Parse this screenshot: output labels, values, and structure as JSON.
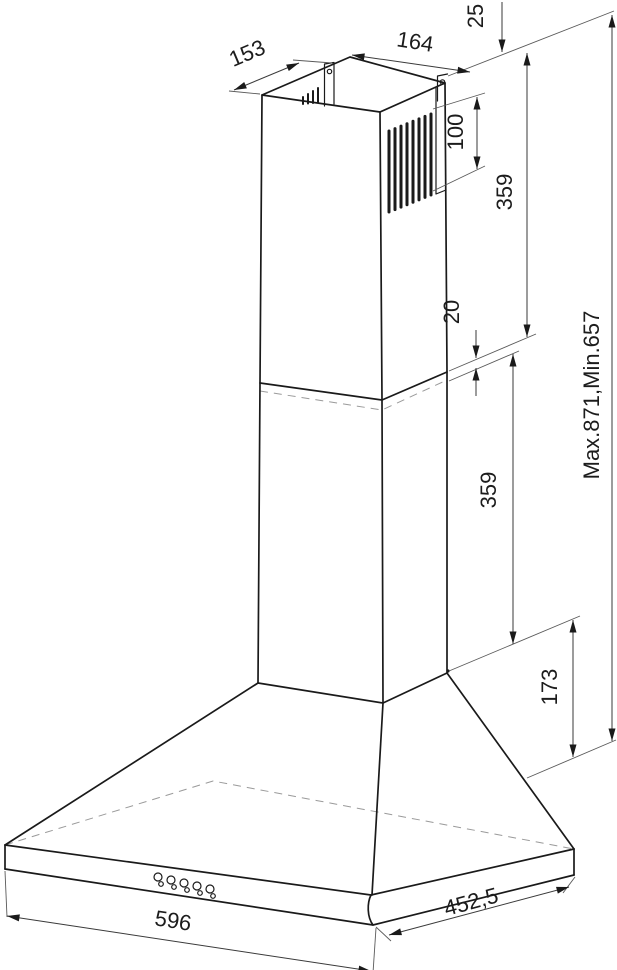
{
  "diagram": {
    "kind": "technical-dimension-drawing",
    "subject": "wall-mounted chimney cooker hood, isometric view with installation dimensions",
    "unit": "mm",
    "line_color": "#1a1a1a",
    "background": "#ffffff",
    "labels": {
      "top_depth": "153",
      "top_width": "164",
      "bracket_offset": "25",
      "vent_slot_height": "100",
      "chimney_upper_section": "359",
      "section_overlap": "20",
      "chimney_lower_section": "359",
      "canopy_height": "173",
      "overall_height": "Max.871,Min.657",
      "body_width": "596",
      "body_depth": "452,5"
    },
    "features": {
      "vent_slots_count": 8,
      "control_buttons_count": 5,
      "mounting_tabs_count": 2
    }
  }
}
